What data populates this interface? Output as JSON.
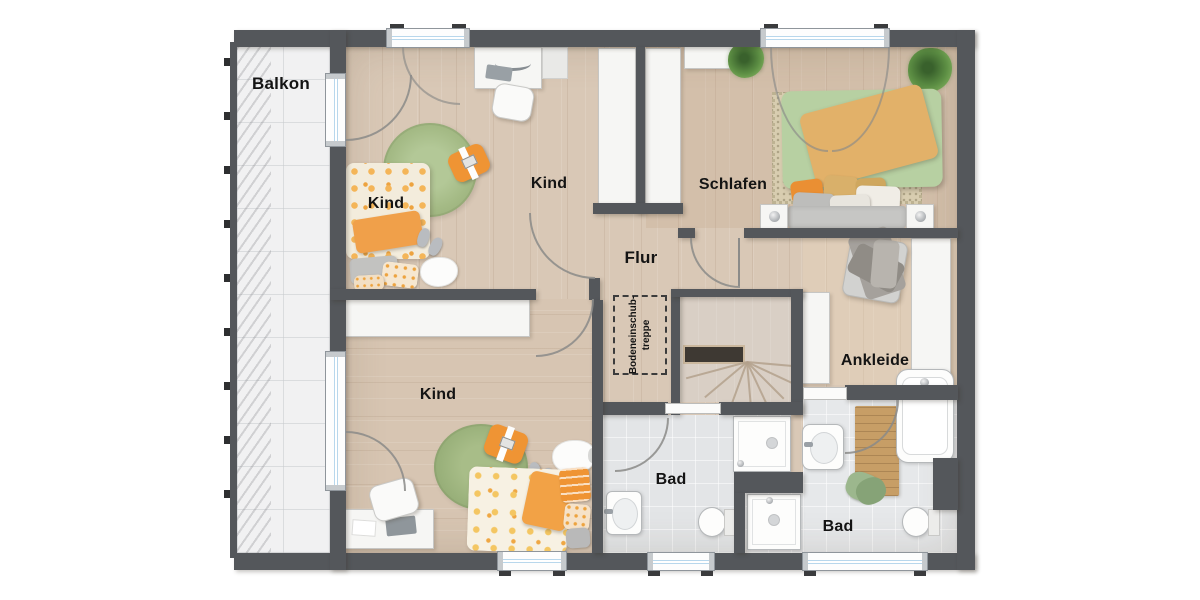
{
  "rooms": {
    "balcony": {
      "label": "Balkon"
    },
    "child_top": {
      "label": "Kind"
    },
    "child_middle": {
      "label": "Kind"
    },
    "bedroom": {
      "label": "Schlafen"
    },
    "hallway": {
      "label": "Flur"
    },
    "child_bottom": {
      "label": "Kind"
    },
    "dressing_room": {
      "label": "Ankleide"
    },
    "bathroom_left": {
      "label": "Bad"
    },
    "bathroom_right": {
      "label": "Bad"
    }
  },
  "annotations": {
    "attic_stair": {
      "line1": "Bodeneinschub-",
      "line2": "treppe"
    }
  },
  "colors": {
    "wall": "#54575b",
    "wood_floor": "#d9c8b6",
    "balcony_floor": "#f1f1f2",
    "bath_floor": "#e3e5e7",
    "stair_floor": "#d9cfc5",
    "glass": "#b8d7ec",
    "furniture_white": "#f6f6f4",
    "rug_green": "#a6bd87",
    "bed_green": "#b7d0a2",
    "accent_orange": "#ee9434",
    "blanket_orange": "#e2b169",
    "wood_mat": "#c79e66"
  }
}
